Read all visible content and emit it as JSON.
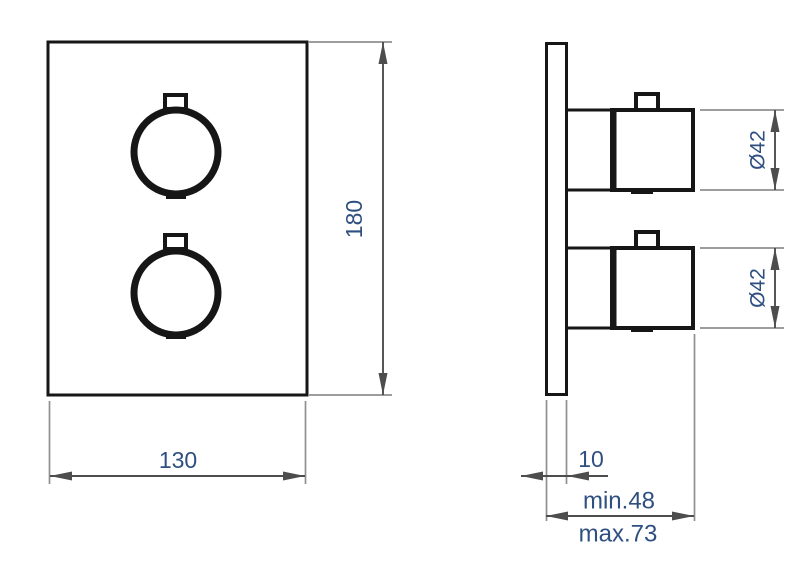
{
  "drawing": {
    "front_view": {
      "width_dimension": "130",
      "height_dimension": "180"
    },
    "side_view": {
      "top_knob_diameter": "Ø42",
      "bottom_knob_diameter": "Ø42",
      "plate_thickness": "10",
      "installation_depth_min": "min.48",
      "installation_depth_max": "max.73"
    },
    "colors": {
      "object_line": "#161616",
      "dimension_line": "#4d4d4d",
      "extension_line": "#8f8f8f",
      "dimension_text": "#2f4f80",
      "background": "#ffffff"
    }
  }
}
